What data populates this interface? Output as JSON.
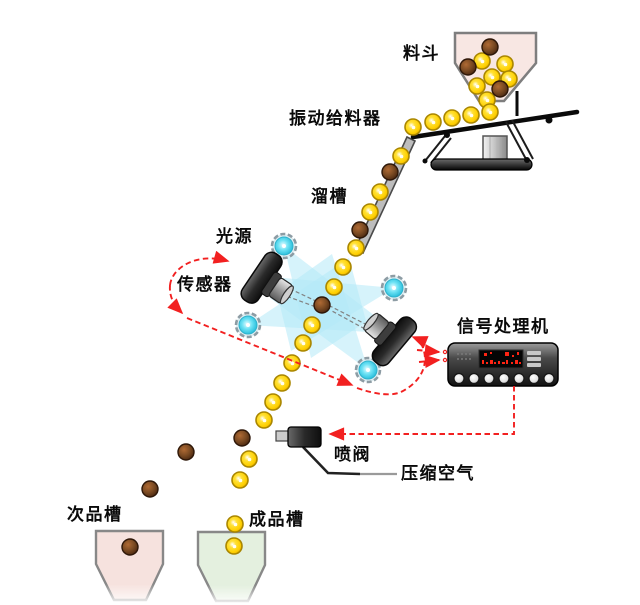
{
  "labels": {
    "hopper": "料斗",
    "vibrating_feeder": "振动给料器",
    "chute": "溜槽",
    "light_source": "光源",
    "sensor": "传感器",
    "signal_processor": "信号处理机",
    "spray_valve": "喷阀",
    "compressed_air": "压缩空气",
    "reject_bin": "次品槽",
    "accept_bin": "成品槽"
  },
  "colors": {
    "accept_ball": "#ffd700",
    "reject_ball": "#7a4a22",
    "light_beam": "#b5e9f7",
    "light_source_cyan": "#35cfe8",
    "signal_path_red": "#f22020",
    "hopper_fill": "#f8e7e3",
    "reject_bin_fill": "#f6e2de",
    "accept_bin_fill": "#e4f0df"
  },
  "lights": [
    [
      284,
      246
    ],
    [
      394,
      288
    ],
    [
      248,
      325
    ],
    [
      368,
      370
    ]
  ],
  "balls": {
    "good": [
      [
        482,
        61
      ],
      [
        505,
        64
      ],
      [
        492,
        77
      ],
      [
        509,
        79
      ],
      [
        477,
        86
      ],
      [
        487,
        100
      ],
      [
        413,
        127
      ],
      [
        433,
        122
      ],
      [
        452,
        118
      ],
      [
        471,
        115
      ],
      [
        490,
        112
      ],
      [
        401,
        156
      ],
      [
        380,
        192
      ],
      [
        370,
        212
      ],
      [
        356,
        248
      ],
      [
        343,
        267
      ],
      [
        334,
        287
      ],
      [
        312,
        325
      ],
      [
        303,
        343
      ],
      [
        292,
        363
      ],
      [
        282,
        383
      ],
      [
        273,
        402
      ],
      [
        264,
        420
      ],
      [
        249,
        459
      ],
      [
        240,
        480
      ],
      [
        235,
        524
      ],
      [
        234,
        546
      ]
    ],
    "bad": [
      [
        490,
        47
      ],
      [
        468,
        67
      ],
      [
        500,
        89
      ],
      [
        390,
        172
      ],
      [
        360,
        230
      ],
      [
        322,
        305
      ],
      [
        242,
        438
      ],
      [
        186,
        452
      ],
      [
        150,
        489
      ],
      [
        130,
        547
      ]
    ]
  },
  "processor": {
    "buttons": 7
  }
}
